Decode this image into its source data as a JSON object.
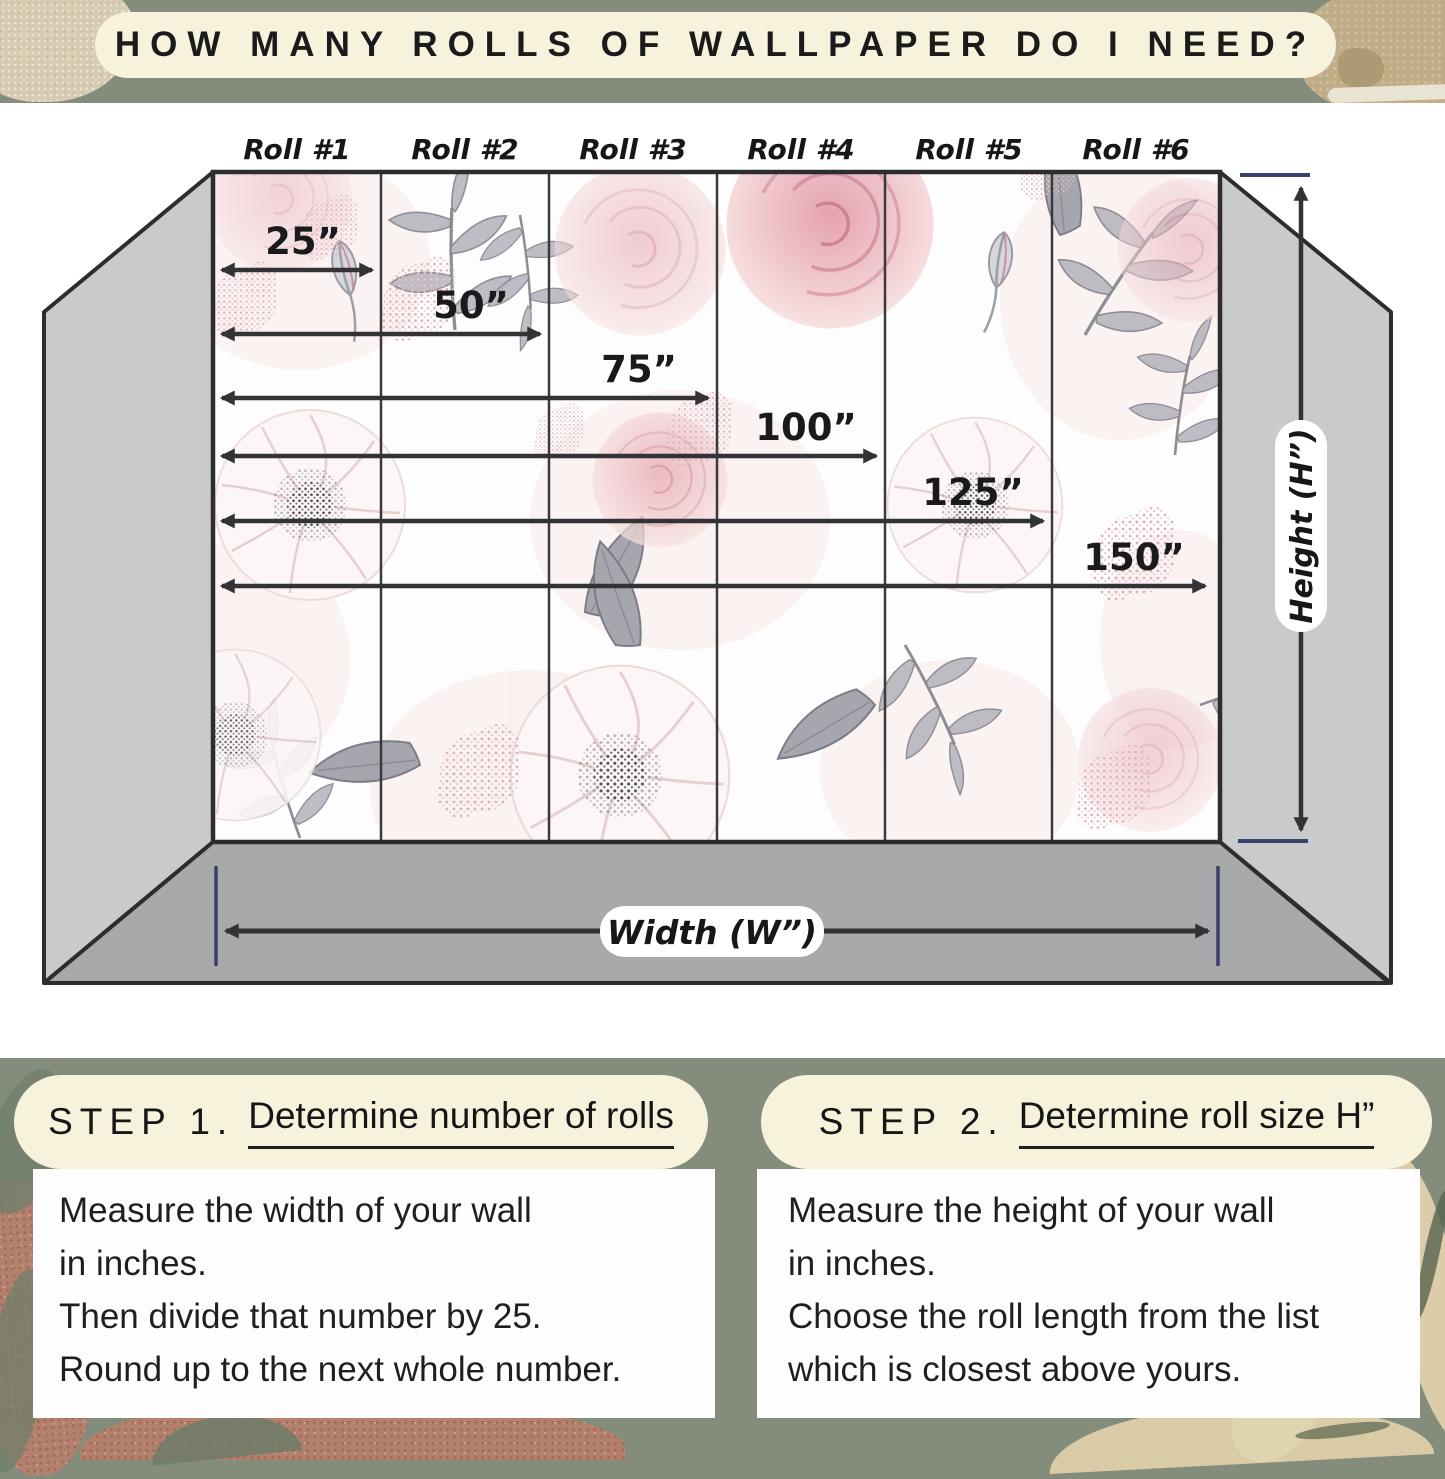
{
  "title": "HOW MANY ROLLS OF WALLPAPER DO I NEED?",
  "diagram": {
    "rolls": [
      "Roll #1",
      "Roll #2",
      "Roll #3",
      "Roll #4",
      "Roll #5",
      "Roll #6"
    ],
    "measurements": [
      "25”",
      "50”",
      "75”",
      "100”",
      "125”",
      "150”"
    ],
    "measurements_inches": [
      25,
      50,
      75,
      100,
      125,
      150
    ],
    "roll_width_inches": 25,
    "height_label": "Height (H”)",
    "width_label": "Width (W”)"
  },
  "steps": {
    "step1": {
      "prefix": "STEP 1.",
      "title": "Determine number of rolls",
      "lines": [
        "Measure the width of your wall",
        "in inches.",
        "Then divide that number by 25.",
        "Round up to the next whole number."
      ]
    },
    "step2": {
      "prefix": "STEP 2.",
      "title": "Determine roll size H”",
      "lines": [
        "Measure the height of your wall",
        "in inches.",
        "Choose the roll length from the list",
        "which is closest above yours."
      ]
    }
  },
  "colors": {
    "background_sage": "#848d7b",
    "banner_cream": "#f6f2dc",
    "text_dark": "#1c1c1c",
    "wall_side_gray": "#c9cacc",
    "floor_gray": "#a8a9ab",
    "outline_dark": "#2d2d2d",
    "tick_navy": "#3b406b",
    "wallpaper_pink": "#eec3c8",
    "wallpaper_leaf_gray": "#a9a9b1",
    "rust_texture": "#b3806e",
    "tan_leaf": "#dbcda9"
  }
}
